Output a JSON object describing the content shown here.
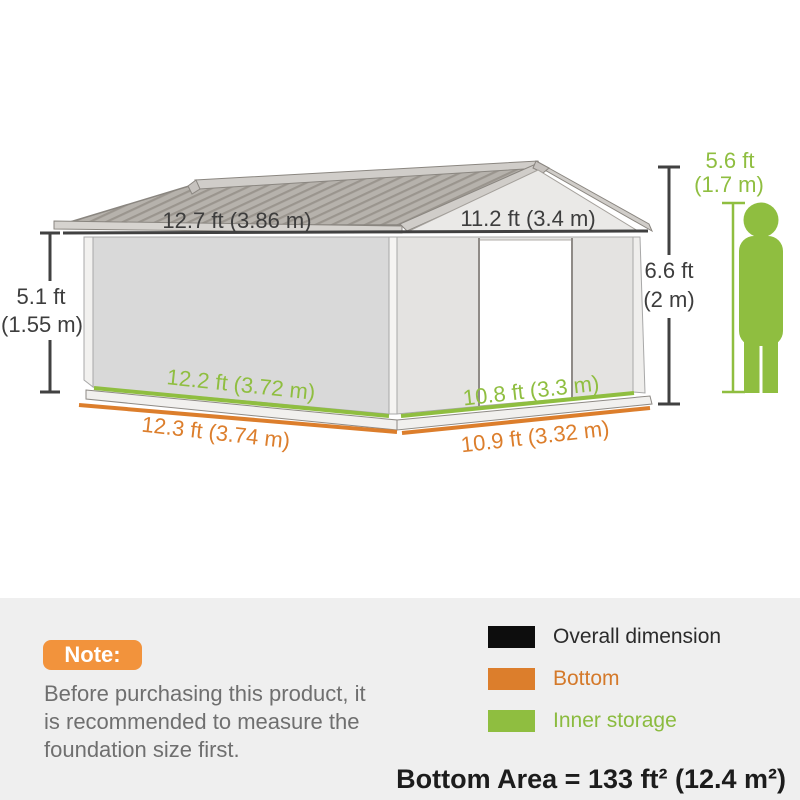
{
  "diagram": {
    "dim_side_top": "12.7 ft (3.86 m)",
    "dim_gable_top": "11.2 ft (3.4 m)",
    "dim_wall_height": [
      "5.1 ft",
      "(1.55 m)"
    ],
    "dim_ridge_height": [
      "6.6 ft",
      "(2 m)"
    ],
    "dim_person_height": [
      "5.6 ft",
      "(1.7 m)"
    ],
    "dim_inner_side": "12.2 ft (3.72 m)",
    "dim_bottom_side": "12.3 ft (3.74 m)",
    "dim_inner_gable": "10.8 ft (3.3 m)",
    "dim_bottom_gable": "10.9 ft (3.32 m)"
  },
  "colors": {
    "overall_dimension": "#1c1c1c",
    "bottom": "#DC7E2C",
    "inner_storage": "#8FBE40",
    "note_badge": "#F2933C",
    "legend_bottom_text": "#d4792a",
    "legend_inner_text": "#8bbb3f"
  },
  "note": {
    "badge_label": "Note:",
    "lines": [
      "Before purchasing this product, it",
      "is recommended to measure the",
      "foundation size first."
    ]
  },
  "legend": {
    "items": [
      {
        "label": "Overall dimension",
        "color": "#0d0d0d",
        "text_color": "#2b2b2b"
      },
      {
        "label": "Bottom",
        "color": "#DC7E2C",
        "text_color": "#d4792a"
      },
      {
        "label": "Inner storage",
        "color": "#8FBE40",
        "text_color": "#8bbb3f"
      }
    ]
  },
  "bottom_area": "Bottom Area = 133 ft² (12.4 m²)"
}
